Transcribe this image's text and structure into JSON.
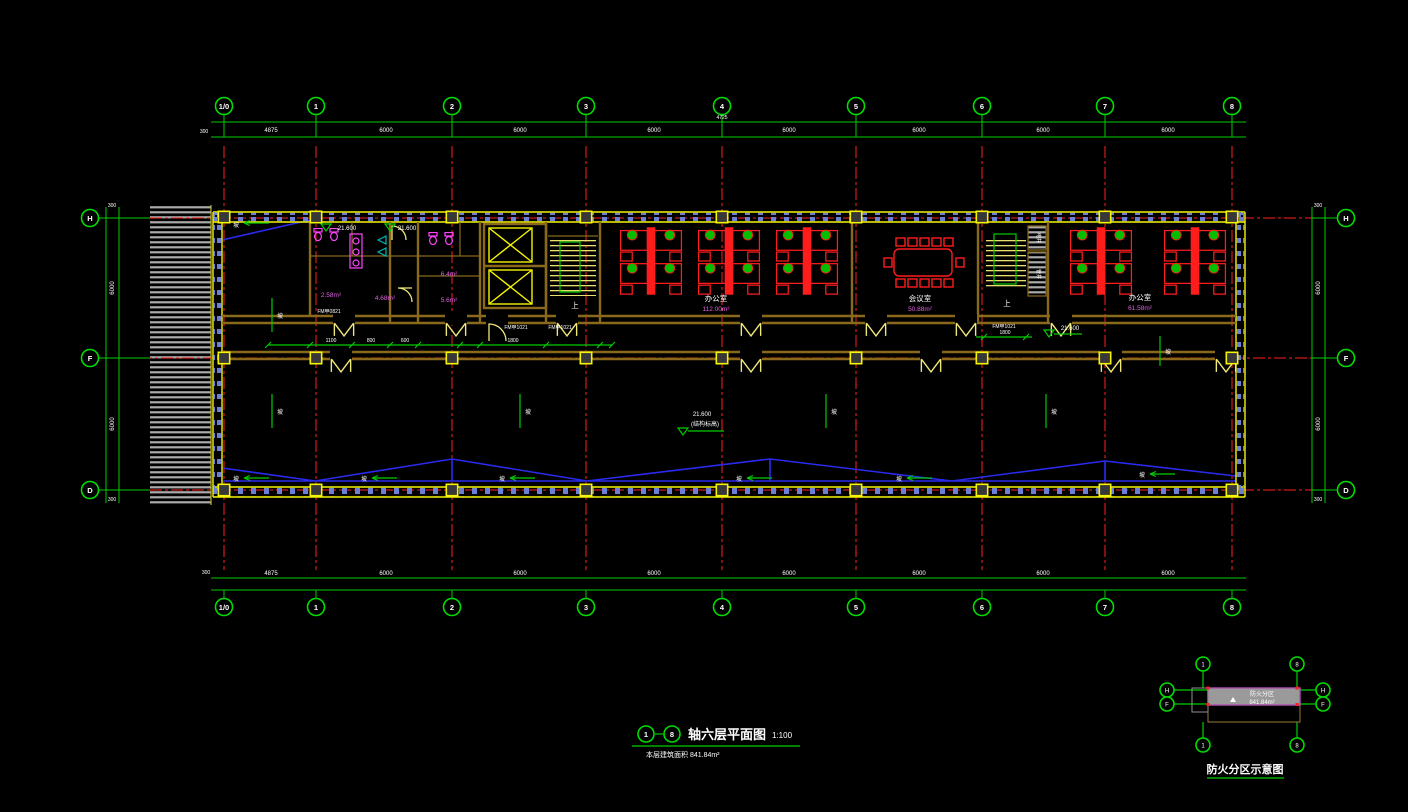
{
  "palette": {
    "background": "#000000",
    "dimension_green": "#00cc00",
    "axis_red": "#ff2020",
    "wall_olive": "#8a6a1a",
    "detail_yellow": "#f5f500",
    "furniture_red": "#ff1c1c",
    "chair_green": "#00c000",
    "fixture_magenta": "#ff44ff",
    "mullion_blue": "#6b7fd4",
    "hatch_gray": "#ababab",
    "area_text_magenta": "#e060e0",
    "zigzag_blue": "#2a2aee",
    "keyplan_fill_gray": "#9a9a9a",
    "keyplan_border_magenta": "#b050b0",
    "text_white": "#ffffff"
  },
  "axes": {
    "cols": [
      "1/0",
      "1",
      "2",
      "3",
      "4",
      "5",
      "6",
      "7",
      "8"
    ],
    "rows": [
      "H",
      "F",
      "D"
    ],
    "top_dims": [
      "4875",
      "6000",
      "6000",
      "6000",
      "6000",
      "6000",
      "6000",
      "6000"
    ],
    "bottom_dims": [
      "4875",
      "6000",
      "6000",
      "6000",
      "6000",
      "6000",
      "6000",
      "6000"
    ],
    "side_dims": [
      "6000",
      "6000"
    ],
    "edge_dim": "300"
  },
  "rooms": {
    "office_left": {
      "label": "办公室",
      "area": "112.00m²"
    },
    "meeting_room": {
      "label": "会议室",
      "area": "50.88m²"
    },
    "office_right": {
      "label": "办公室",
      "area": "61.58m²"
    },
    "toilet_areas": [
      "2.58m²",
      "4.68m²",
      "6.4m²",
      "5.6m²"
    ],
    "shaft_labels": [
      "电井",
      "管井"
    ],
    "stair_up": "上"
  },
  "annotations": {
    "level_value": "21.600",
    "level_note": "(结构标高)",
    "slope_char": "坡",
    "door_tag_a": "FM甲0821",
    "door_tag_b": "FM甲1021",
    "top_extra_dim": "4725",
    "interior_dims": [
      "1100",
      "800",
      "600",
      "1800"
    ]
  },
  "titleblock": {
    "bubble_from": "1",
    "bubble_to": "8",
    "title": "轴六层平面图",
    "scale": "1:100",
    "subtitle": "本层建筑面积 841.84m²"
  },
  "keyplan": {
    "caption": "防火分区示意图",
    "zone_label": "防火分区",
    "zone_area": "841.84m²",
    "bubble_left": "1",
    "bubble_right": "8",
    "row_top": "H",
    "row_bottom": "F"
  }
}
